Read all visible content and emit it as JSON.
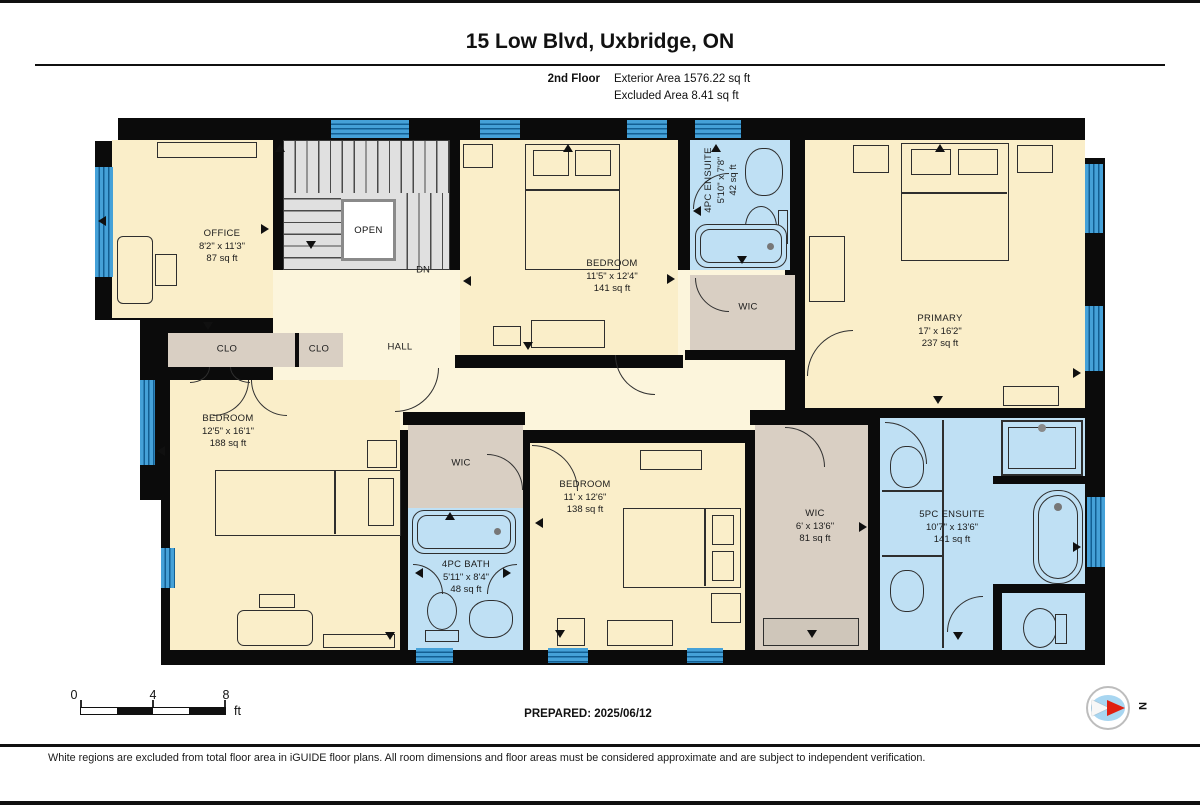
{
  "header": {
    "title": "15 Low Blvd, Uxbridge, ON",
    "floor_label": "2nd Floor",
    "area_line1": "Exterior Area 1576.22 sq ft",
    "area_line2": "Excluded Area 8.41 sq ft"
  },
  "rooms": {
    "office": {
      "name": "OFFICE",
      "dims": "8'2\" x 11'3\"",
      "area": "87 sq ft"
    },
    "bedroom_top": {
      "name": "BEDROOM",
      "dims": "11'5\" x 12'4\"",
      "area": "141 sq ft"
    },
    "ensuite4": {
      "name": "4PC ENSUITE",
      "dims": "5'10\" x 7'8\"",
      "area": "42 sq ft"
    },
    "wic_top": {
      "name": "WIC"
    },
    "primary": {
      "name": "PRIMARY",
      "dims": "17' x 16'2\"",
      "area": "237 sq ft"
    },
    "clo1": {
      "name": "CLO"
    },
    "clo2": {
      "name": "CLO"
    },
    "hall": {
      "name": "HALL"
    },
    "stairs": {
      "open": "OPEN",
      "dn": "DN"
    },
    "bedroom_left": {
      "name": "BEDROOM",
      "dims": "12'5\" x 16'1\"",
      "area": "188 sq ft"
    },
    "wic_mid": {
      "name": "WIC"
    },
    "bath4": {
      "name": "4PC BATH",
      "dims": "5'11\" x 8'4\"",
      "area": "48 sq ft"
    },
    "bedroom_mid": {
      "name": "BEDROOM",
      "dims": "11' x 12'6\"",
      "area": "138 sq ft"
    },
    "wic_right": {
      "name": "WIC",
      "dims": "6' x 13'6\"",
      "area": "81 sq ft"
    },
    "ensuite5": {
      "name": "5PC ENSUITE",
      "dims": "10'7\" x 13'6\"",
      "area": "141 sq ft"
    }
  },
  "footer": {
    "scale_ticks": [
      "0",
      "4",
      "8"
    ],
    "scale_unit": "ft",
    "prepared": "PREPARED: 2025/06/12",
    "compass_north": "N",
    "disclaimer": "White regions are excluded from total floor area in iGUIDE floor plans. All room dimensions and floor areas must be considered approximate and are subject to independent verification."
  },
  "colors": {
    "wall": "#0b0b0b",
    "room_cream": "#faeec9",
    "hall_cream": "#fcf5dc",
    "closet_tan": "#d9cfc3",
    "bath_blue": "#bfe0f4",
    "window_blue": "#45a1d8",
    "stairs_gray": "#e0e0e0",
    "compass_red": "#e01f10",
    "compass_blue": "#a8d6f1"
  }
}
